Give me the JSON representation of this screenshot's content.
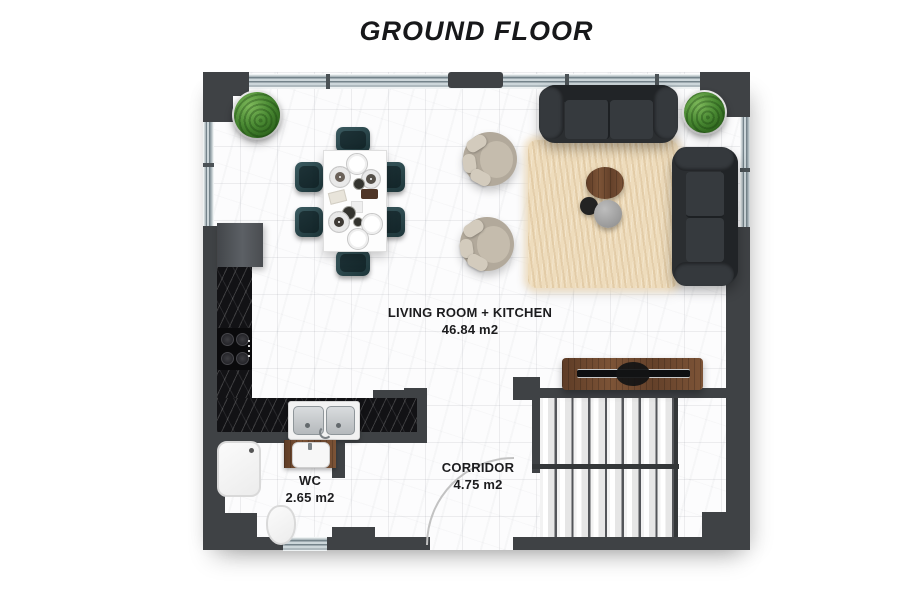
{
  "title": {
    "text": "GROUND FLOOR"
  },
  "rooms": {
    "living": {
      "name": "LIVING ROOM + KITCHEN",
      "area": "46.84 m2"
    },
    "wc": {
      "name": "WC",
      "area": "2.65 m2"
    },
    "corridor": {
      "name": "CORRIDOR",
      "area": "4.75 m2"
    }
  },
  "colors": {
    "wall": "#3f4245",
    "window_glass": "#ccd6da",
    "floor_tile": "#fcfcfd",
    "kitchen_counter_marble": "#121215",
    "sofa": "#2b2e31",
    "dining_chair": "#2c484d",
    "rug": "#eedcbc",
    "wood": "#6e4831",
    "plant": "#4a8a33",
    "label_text": "#1c1c1e"
  },
  "furniture": [
    "plant",
    "dining-table",
    "dining-chair",
    "armchair",
    "two-seat-sofa",
    "three-seat-sofa",
    "shaggy-rug",
    "coffee-table",
    "tv-console",
    "fridge",
    "kitchen-counter",
    "cooktop",
    "double-sink",
    "shower-tray",
    "washbasin-vanity",
    "toilet",
    "staircase",
    "entrance-door-swing"
  ]
}
